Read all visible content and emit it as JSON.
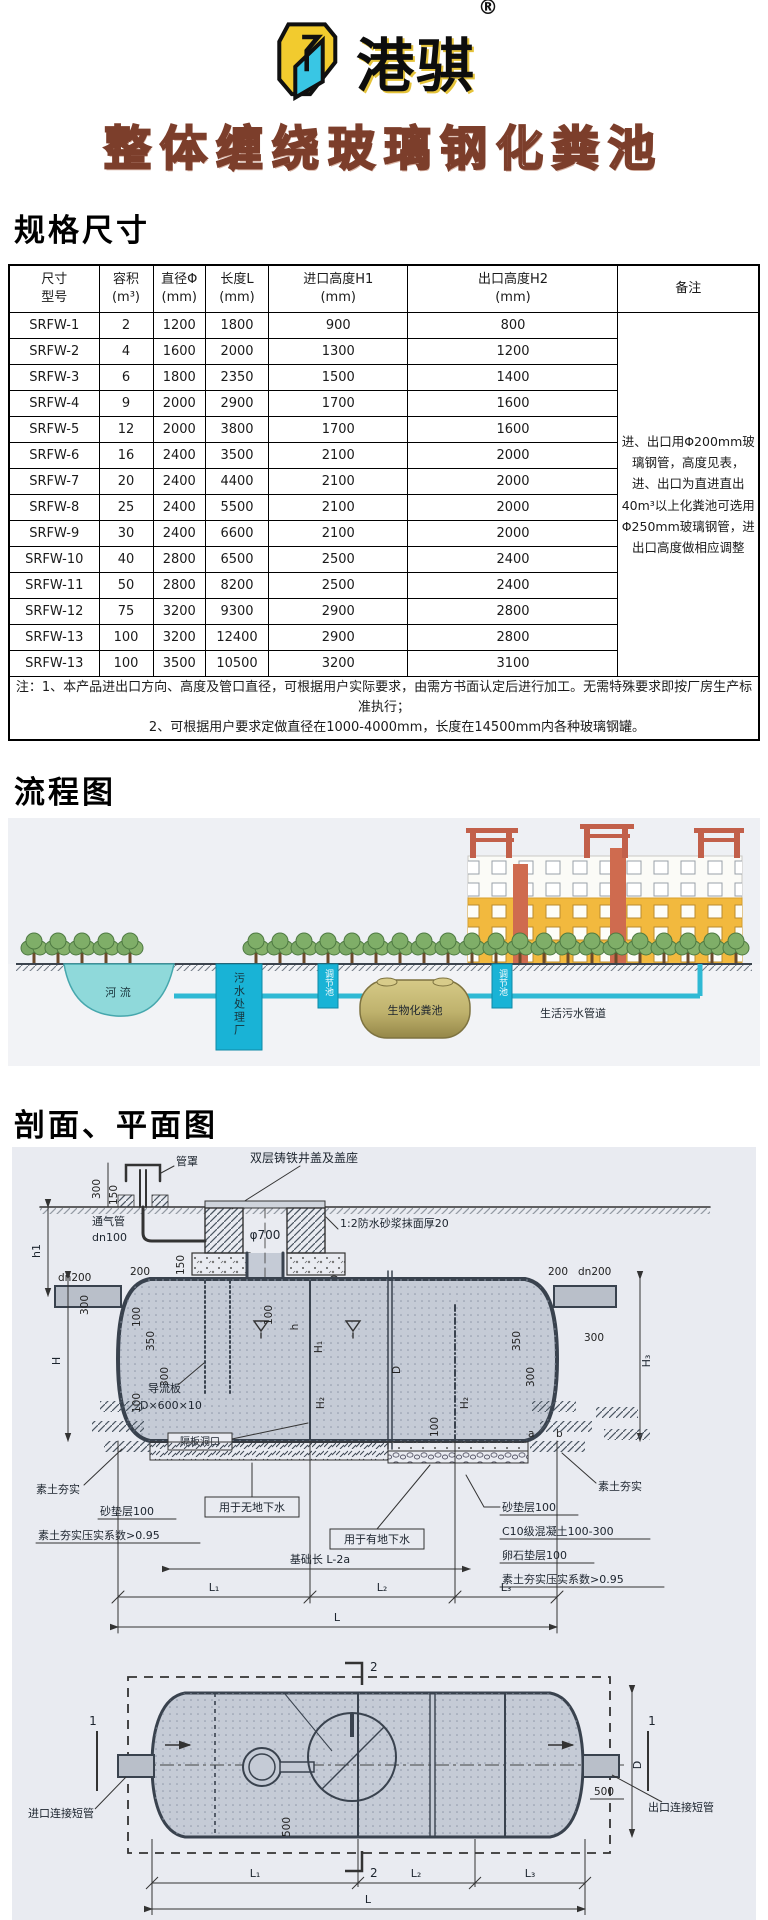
{
  "header": {
    "brand": "港骐",
    "reg_mark": "®",
    "title": "整体缠绕玻璃钢化粪池"
  },
  "specs": {
    "heading": "规格尺寸",
    "table": {
      "headers": {
        "model_l1": "尺寸",
        "model_l2": "型号",
        "volume_l1": "容积",
        "volume_l2": "(m³)",
        "diameter_l1": "直径Φ",
        "diameter_l2": "(mm)",
        "length_l1": "长度L",
        "length_l2": "(mm)",
        "inlet_l1": "进口高度H1",
        "inlet_l2": "(mm)",
        "outlet_l1": "出口高度H2",
        "outlet_l2": "(mm)",
        "remark": "备注"
      },
      "rows": [
        {
          "model": "SRFW-1",
          "volume": "2",
          "diameter": "1200",
          "length": "1800",
          "h1": "900",
          "h2": "800"
        },
        {
          "model": "SRFW-2",
          "volume": "4",
          "diameter": "1600",
          "length": "2000",
          "h1": "1300",
          "h2": "1200"
        },
        {
          "model": "SRFW-3",
          "volume": "6",
          "diameter": "1800",
          "length": "2350",
          "h1": "1500",
          "h2": "1400"
        },
        {
          "model": "SRFW-4",
          "volume": "9",
          "diameter": "2000",
          "length": "2900",
          "h1": "1700",
          "h2": "1600"
        },
        {
          "model": "SRFW-5",
          "volume": "12",
          "diameter": "2000",
          "length": "3800",
          "h1": "1700",
          "h2": "1600"
        },
        {
          "model": "SRFW-6",
          "volume": "16",
          "diameter": "2400",
          "length": "3500",
          "h1": "2100",
          "h2": "2000"
        },
        {
          "model": "SRFW-7",
          "volume": "20",
          "diameter": "2400",
          "length": "4400",
          "h1": "2100",
          "h2": "2000"
        },
        {
          "model": "SRFW-8",
          "volume": "25",
          "diameter": "2400",
          "length": "5500",
          "h1": "2100",
          "h2": "2000"
        },
        {
          "model": "SRFW-9",
          "volume": "30",
          "diameter": "2400",
          "length": "6600",
          "h1": "2100",
          "h2": "2000"
        },
        {
          "model": "SRFW-10",
          "volume": "40",
          "diameter": "2800",
          "length": "6500",
          "h1": "2500",
          "h2": "2400"
        },
        {
          "model": "SRFW-11",
          "volume": "50",
          "diameter": "2800",
          "length": "8200",
          "h1": "2500",
          "h2": "2400"
        },
        {
          "model": "SRFW-12",
          "volume": "75",
          "diameter": "3200",
          "length": "9300",
          "h1": "2900",
          "h2": "2800"
        },
        {
          "model": "SRFW-13",
          "volume": "100",
          "diameter": "3200",
          "length": "12400",
          "h1": "2900",
          "h2": "2800"
        },
        {
          "model": "SRFW-13",
          "volume": "100",
          "diameter": "3500",
          "length": "10500",
          "h1": "3200",
          "h2": "3100"
        }
      ],
      "remark": "进、出口用Φ200mm玻璃钢管，高度见表，进、出口为直进直出40m³以上化粪池可选用Φ250mm玻璃钢管，进出口高度做相应调整",
      "notes": [
        "注：1、本产品进出口方向、高度及管口直径，可根据用户实际要求，由需方书面认定后进行加工。无需特殊要求即按厂房生产标准执行；",
        "2、可根据用户要求定做直径在1000-4000mm，长度在14500mm内各种玻璃钢罐。"
      ]
    }
  },
  "flow": {
    "heading": "流程图",
    "labels": {
      "river": "河 流",
      "plant": "污水处理厂",
      "reg": "调节池",
      "tank": "生物化粪池",
      "pipe": "生活污水管道"
    }
  },
  "drawing": {
    "heading": "剖面、平面图",
    "sec": {
      "pipe_cap": "管罩",
      "cover": "双层铸铁井盖及盖座",
      "vent": "通气管",
      "dn100": "dn100",
      "phi700": "φ700",
      "mortar": "1:2防水砂浆抹面厚20",
      "pad": "390(515)",
      "deflector": "导流板",
      "deflector_size": "D×600×10",
      "baffle": "隔板洞口",
      "soil": "素土夯实",
      "sand": "砂垫层100",
      "coeff": "素土夯实压实系数>0.95",
      "no_gw": "用于无地下水",
      "gw": "用于有地下水",
      "foundation": "基础长 L-2a"
    },
    "right_list": [
      "砂垫层100",
      "C10级混凝土100-300",
      "卵石垫层100",
      "素土夯实压实系数>0.95"
    ],
    "dims": {
      "v300": "300",
      "v150": "150",
      "v500": "500",
      "v100": "100",
      "v350": "350",
      "n200": "200",
      "dn200": "dn200",
      "h1": "h1",
      "H": "H",
      "H1": "H₁",
      "H2": "H₂",
      "H3": "H₃",
      "h": "h",
      "D": "D",
      "a": "a",
      "b": "b",
      "L": "L",
      "L1": "L₁",
      "L2": "L₂",
      "L3": "L₃",
      "s500": "500"
    },
    "plan": {
      "inlet": "进口连接短管",
      "outlet": "出口连接短管",
      "m1": "1",
      "m2": "2"
    }
  }
}
